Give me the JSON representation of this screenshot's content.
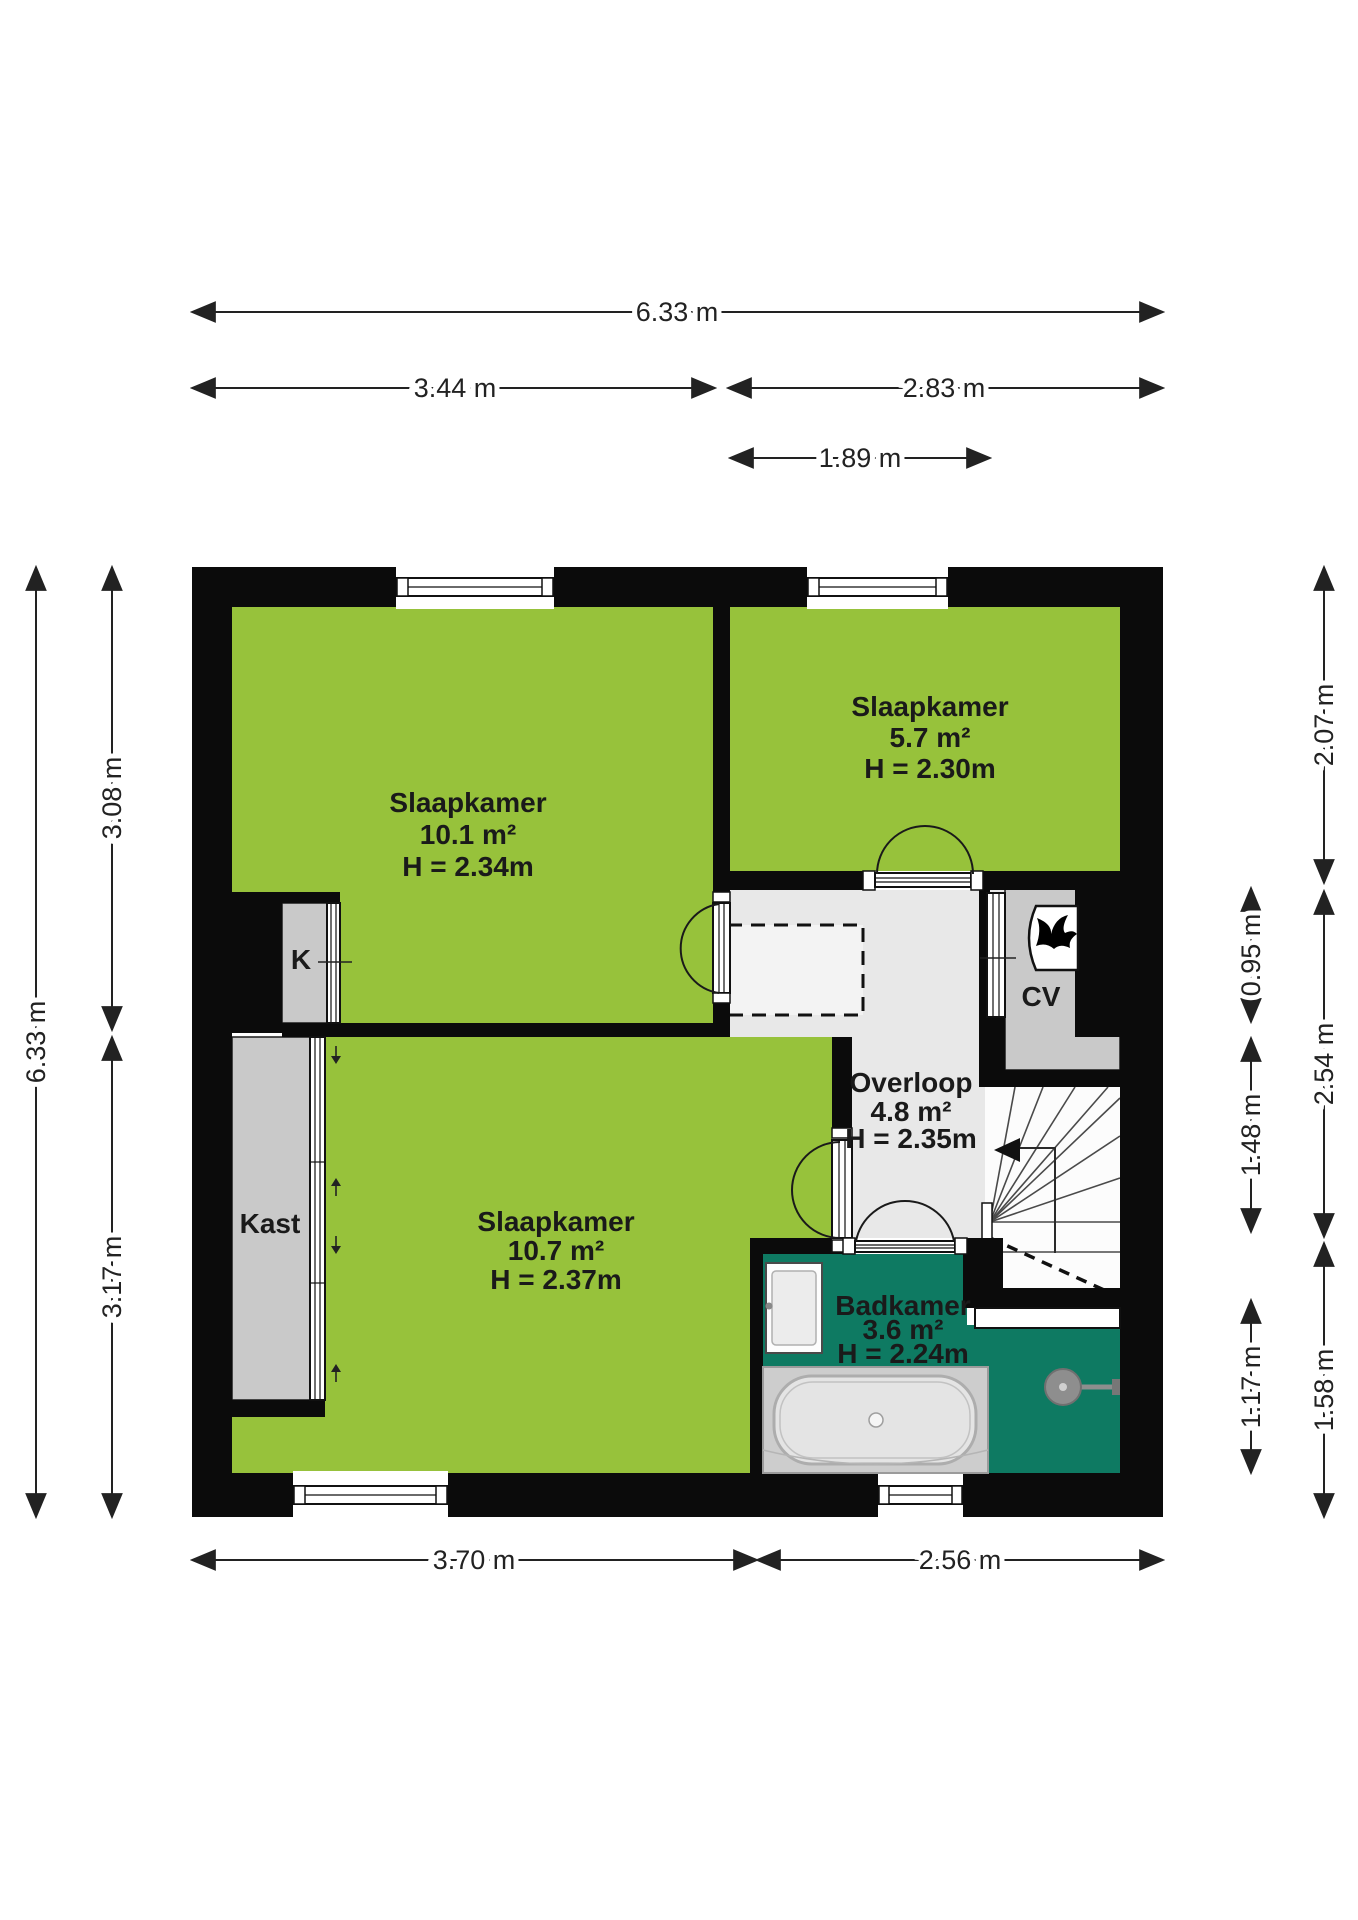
{
  "plan": {
    "title": "floor-plan-upper-floor",
    "rooms": [
      {
        "name": "Slaapkamer",
        "area": "10.1 m²",
        "height": "H = 2.34m"
      },
      {
        "name": "Slaapkamer",
        "area": "5.7 m²",
        "height": "H = 2.30m"
      },
      {
        "name": "Slaapkamer",
        "area": "10.7 m²",
        "height": "H = 2.37m"
      },
      {
        "name": "Overloop",
        "area": "4.8 m²",
        "height": "H = 2.35m"
      },
      {
        "name": "Badkamer",
        "area": "3.6 m²",
        "height": "H = 2.24m"
      }
    ],
    "closets": {
      "k_label": "K",
      "kast_label": "Kast",
      "cv_label": "CV"
    },
    "dimensions": {
      "top_total": "6.33 m",
      "top_left": "3.44 m",
      "top_right": "2.83 m",
      "top_inner": "1.89 m",
      "bottom_left": "3.70 m",
      "bottom_right": "2.56 m",
      "left_total": "6.33 m",
      "left_upper": "3.08 m",
      "left_lower": "3.17 m",
      "right_upper_outer": "2.07 m",
      "right_cv": "0.95 m",
      "right_middle_outer": "2.54 m",
      "right_stairs": "1.48 m",
      "right_shower": "1.17 m",
      "right_lower_outer": "1.58 m"
    },
    "icons": [
      "flame-icon",
      "shower-head-icon",
      "stairs-arrow-icon"
    ],
    "colors": {
      "room_green": "#97c23b",
      "bathroom_teal": "#0e7a62",
      "floor_gray": "#e8e8e8",
      "closet_gray": "#c9c9c9",
      "wall_black": "#0b0b0b"
    }
  }
}
